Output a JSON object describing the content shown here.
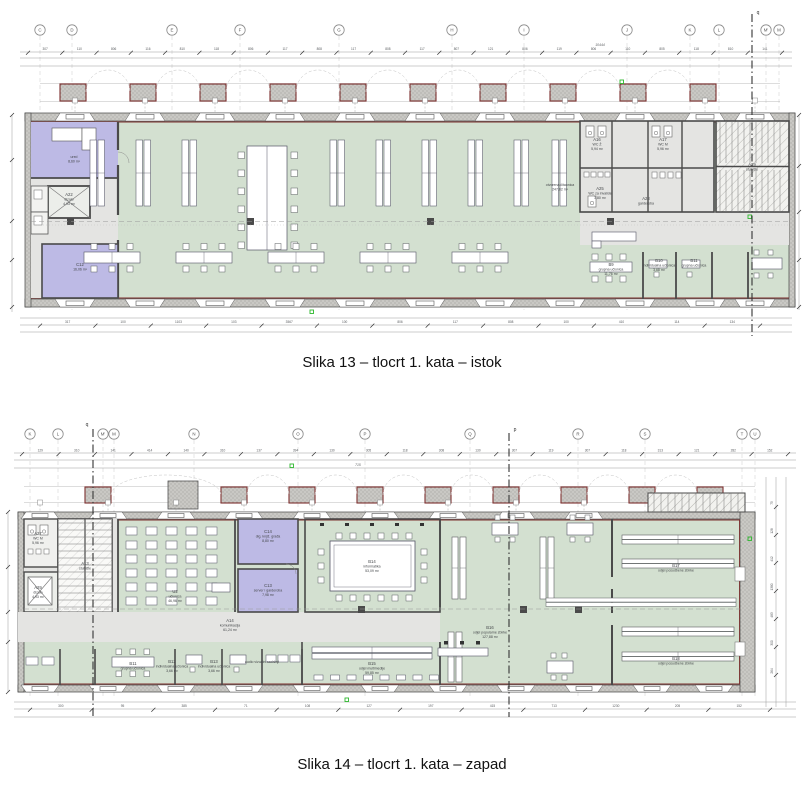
{
  "colors": {
    "room_green": "#d3e0d0",
    "room_purple": "#bdbae5",
    "wall_gray": "#c9c8c4",
    "accent_red": "#7c2f2e",
    "marker_green": "#2eb82e",
    "line_dark": "#4a4a4a",
    "dim_text": "#5a5d60"
  },
  "figures": [
    {
      "caption": "Slika 13 – tlocrt 1. kata – istok",
      "grid_letters": [
        "C",
        "D",
        "E",
        "F",
        "G",
        "H",
        "I",
        "J",
        "K",
        "L",
        "M'",
        "M"
      ],
      "section_marks": [
        "q"
      ],
      "total_length": "10444",
      "dim_top": [
        "307",
        "110",
        "806",
        "116",
        "810",
        "118",
        "806",
        "117",
        "808",
        "117",
        "808",
        "117",
        "807",
        "121",
        "806",
        "119",
        "806",
        "110",
        "805",
        "118",
        "810",
        "141"
      ],
      "dim_bottom": [
        "317",
        "100",
        "1103",
        "103",
        "3567",
        "100",
        "806",
        "117",
        "808",
        "100",
        "410",
        "114",
        "134"
      ],
      "rooms": [
        {
          "id": "A22",
          "name": "dizalo",
          "area": "4,93 m²"
        },
        {
          "id": "",
          "name": "ured",
          "area": "8,60 m²"
        },
        {
          "id": "C12",
          "name": "",
          "area": "16,06 m²"
        },
        {
          "id": "",
          "name": "otvorena čitaonica",
          "area": "247,82 m²"
        },
        {
          "id": "A16",
          "name": "WC Ž",
          "area": "5,94 m²"
        },
        {
          "id": "A17",
          "name": "WC M",
          "area": "5,96 m²"
        },
        {
          "id": "A25",
          "name": "WC za invalide",
          "area": "3,80 m²"
        },
        {
          "id": "A28",
          "name": "garderoba",
          "area": ""
        },
        {
          "id": "A29",
          "name": "stubište",
          "area": ""
        },
        {
          "id": "B9",
          "name": "grupna učionica",
          "area": "11,76 m²"
        },
        {
          "id": "B10",
          "name": "individualna učionica",
          "area": "3,68 m²"
        },
        {
          "id": "B11",
          "name": "grupna učionica",
          "area": ""
        }
      ]
    },
    {
      "caption": "Slika 14 – tlocrt 1. kata – zapad",
      "grid_letters": [
        "K",
        "L",
        "M'",
        "M",
        "N",
        "O",
        "P",
        "Q",
        "R",
        "S",
        "T",
        "U"
      ],
      "section_marks": [
        "q",
        "p"
      ],
      "dim_top": [
        "129",
        "310",
        "141",
        "414",
        "140",
        "310",
        "137",
        "394",
        "130",
        "305",
        "118",
        "308",
        "130",
        "307",
        "119",
        "307",
        "118",
        "313",
        "121",
        "282",
        "152"
      ],
      "dim_mid": [
        "715"
      ],
      "dim_bottom": [
        "300",
        "95",
        "385",
        "71",
        "108",
        "127",
        "197",
        "415",
        "713",
        "1230",
        "205",
        "152"
      ],
      "dim_right": [
        "75",
        "128",
        "412",
        "1380",
        "483",
        "300",
        "264"
      ],
      "rooms": [
        {
          "id": "A27",
          "name": "WC M",
          "area": "5,96 m²"
        },
        {
          "id": "A29",
          "name": "dizalo",
          "area": "4,93 m²"
        },
        {
          "id": "A13",
          "name": "stubište",
          "area": ""
        },
        {
          "id": "U2",
          "name": "učionica",
          "area": "46,96 m²"
        },
        {
          "id": "C14",
          "name": "dig. knjiž. građa",
          "area": "8,80 m²"
        },
        {
          "id": "C13",
          "name": "server i garderoba",
          "area": "7,98 m²"
        },
        {
          "id": "B14",
          "name": "informatika",
          "area": "53,09 m²"
        },
        {
          "id": "B15",
          "name": "odjel multimedije",
          "area": "59,85 m²"
        },
        {
          "id": "B16",
          "name": "odjel popularne zbirke",
          "area": "127,88 m²"
        },
        {
          "id": "B17",
          "name": "odjel posudbene zbirke",
          "area": ""
        },
        {
          "id": "B18",
          "name": "odjel posudbene zbirke",
          "area": ""
        },
        {
          "id": "A14",
          "name": "komunikacija",
          "area": "61,24 m²"
        },
        {
          "id": "B11",
          "name": "grupna učionica",
          "area": ""
        },
        {
          "id": "B12",
          "name": "individualna učionica",
          "area": "3,66 m²"
        },
        {
          "id": "B13",
          "name": "individualna učionica",
          "area": "3,66 m²"
        },
        {
          "id": "",
          "name": "audio vizualni sadržaji",
          "area": ""
        }
      ]
    }
  ]
}
